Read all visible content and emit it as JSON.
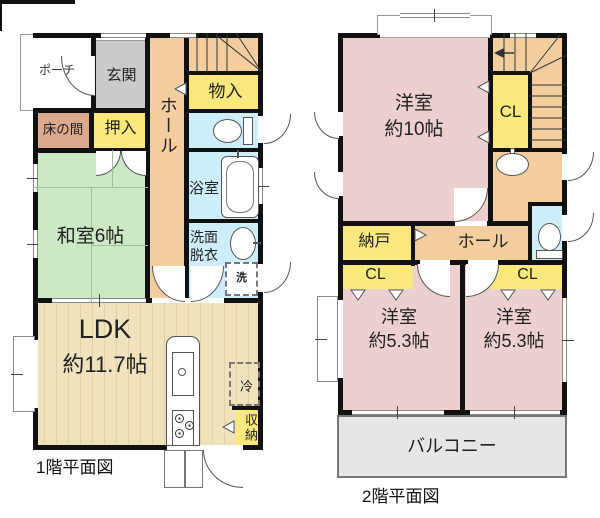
{
  "palette": {
    "wall": "#111111",
    "hall_floor": "#F2CE9F",
    "tatami_green": "#CCE8C4",
    "closet_yellow": "#F8E87D",
    "wet_blue": "#CDEEF8",
    "bedroom_pink": "#ECCFCF",
    "genkan_gray": "#CBCBCB",
    "tokonoma_tan": "#DCA98C",
    "ldk_floor": "#EFE2BD",
    "balcony_gray": "#E6E6E6"
  },
  "floor1": {
    "caption": "1階平面図",
    "rooms": {
      "porch": "ポーチ",
      "genkan": "玄関",
      "hall": "ホール",
      "monoire": "物入",
      "tokonoma": "床の間",
      "oshiire": "押入",
      "washitsu": "和室6帖",
      "bath": "浴室",
      "senmen_l1": "洗面",
      "senmen_l2": "脱衣",
      "washer": "洗",
      "ldk_l1": "LDK",
      "ldk_l2": "約11.7帖",
      "fridge": "冷",
      "shunou": "収納"
    }
  },
  "floor2": {
    "caption": "2階平面図",
    "rooms": {
      "yoshitsu10_l1": "洋室",
      "yoshitsu10_l2": "約10帖",
      "cl_stairs": "CL",
      "nando": "納戸",
      "hall": "ホール",
      "cl_left": "CL",
      "cl_right": "CL",
      "yo53_left_l1": "洋室",
      "yo53_left_l2": "約5.3帖",
      "yo53_right_l1": "洋室",
      "yo53_right_l2": "約5.3帖",
      "balcony": "バルコニー"
    }
  }
}
